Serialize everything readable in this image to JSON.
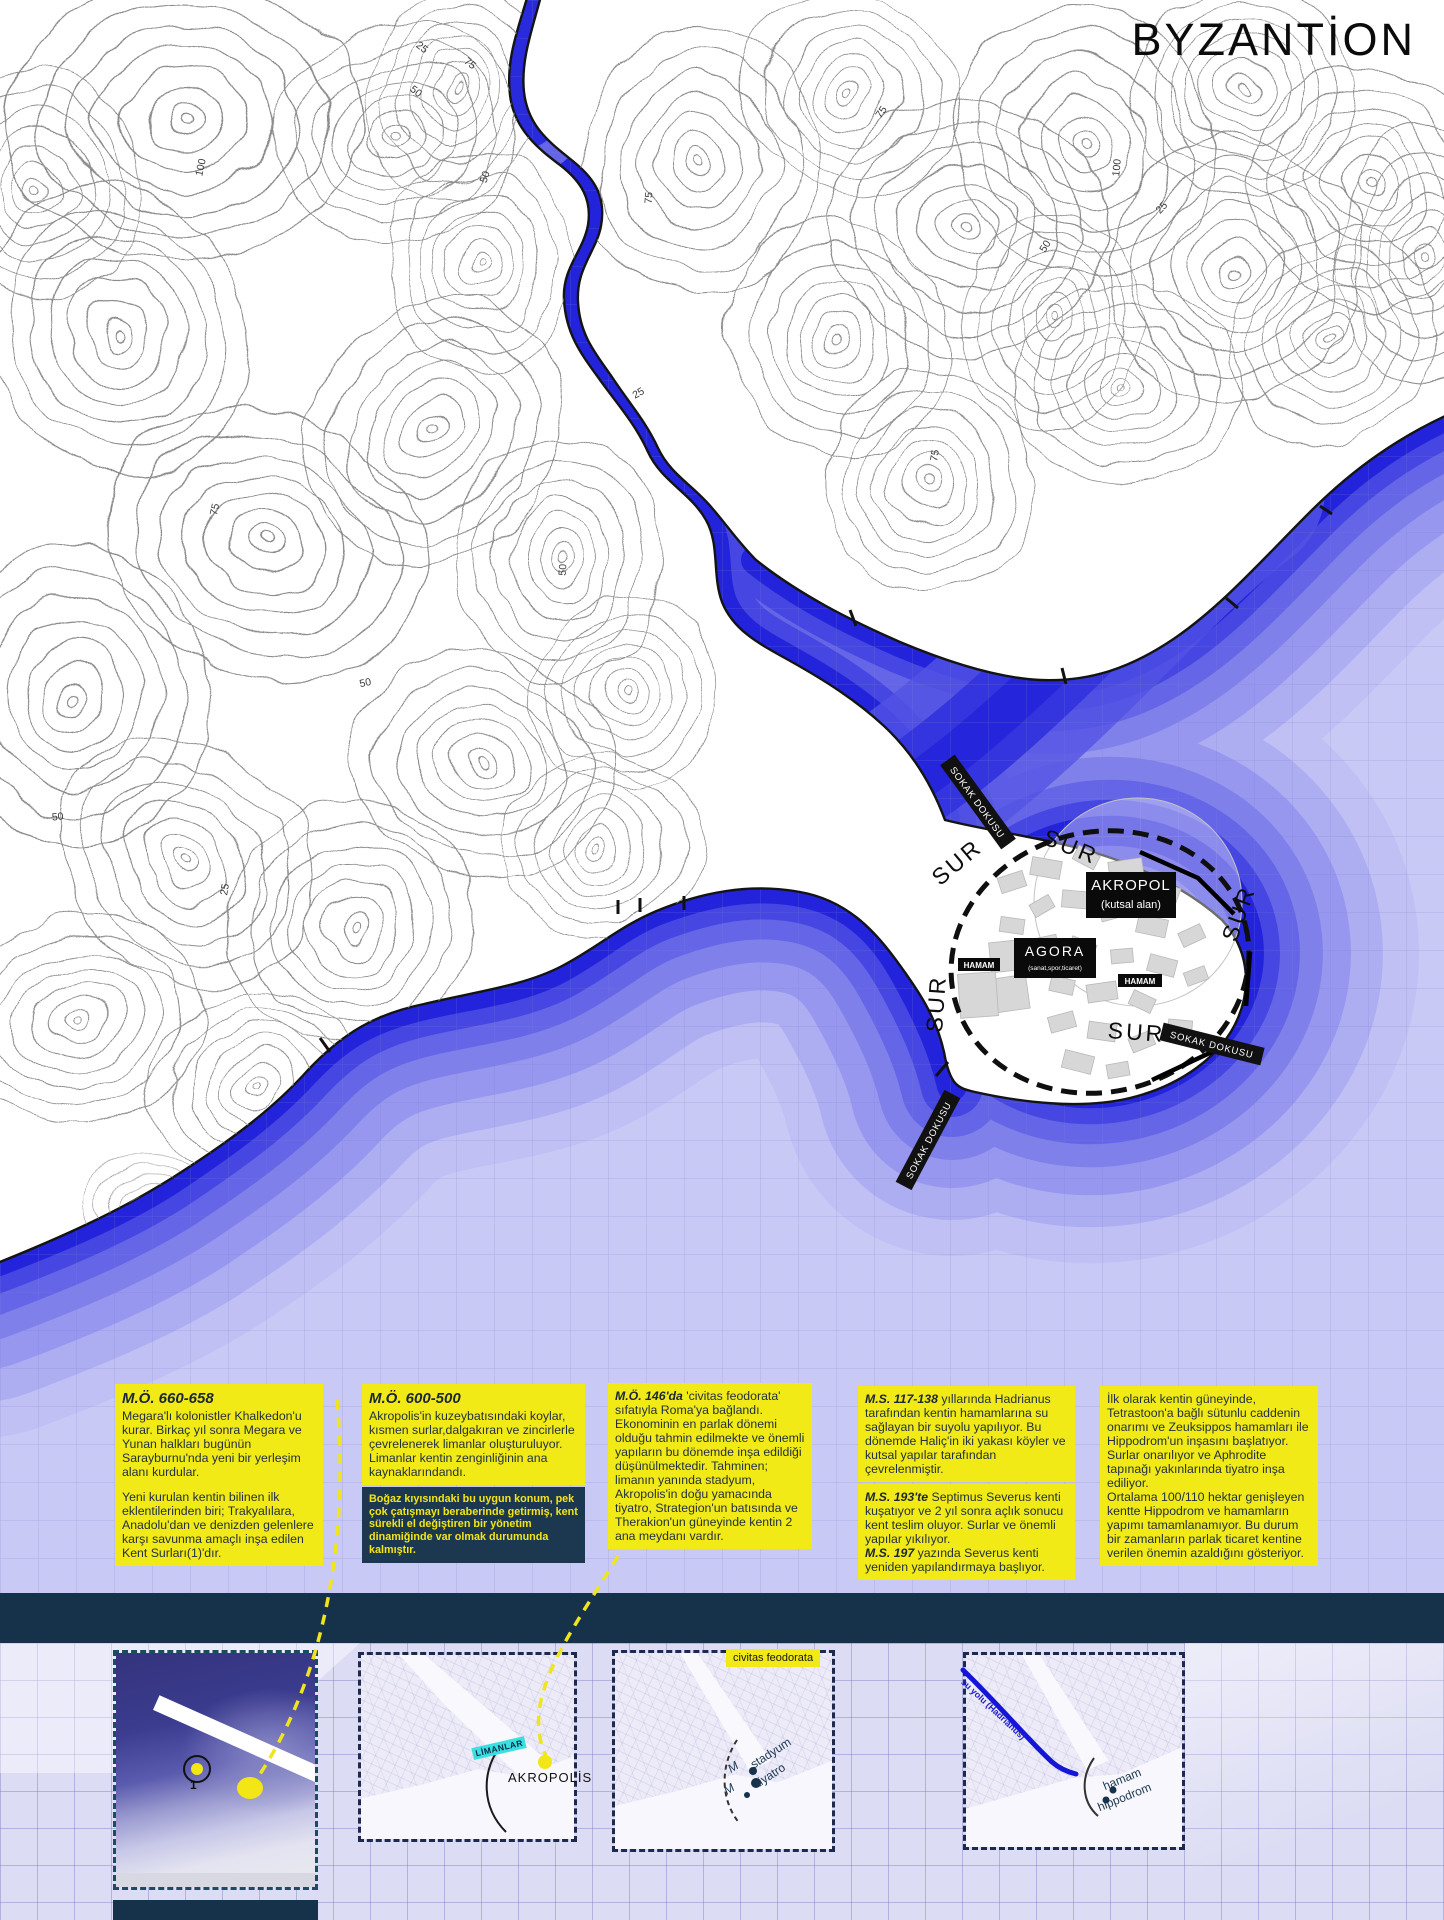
{
  "map": {
    "title": "BYZANTİON",
    "akropol": "AKROPOL",
    "akropol_sub": "(kutsal alan)",
    "agora": "AGORA",
    "agora_sub": "(sanat,spor,ticaret)",
    "hamam": "HAMAM",
    "sur": "SUR",
    "sokak_dokusu": "SOKAK DOKUSU"
  },
  "contour_labels": [
    "100",
    "25",
    "50",
    "75",
    "50",
    "75",
    "75",
    "100",
    "25",
    "75",
    "50",
    "50",
    "25",
    "50",
    "75",
    "50",
    "25"
  ],
  "timeline": [
    {
      "lead": "M.Ö. 660-658",
      "body": "Megara'lı kolonistler Khalkedon'u kurar. Birkaç yıl sonra Megara ve Yunan halkları bugünün Sarayburnu'nda yeni bir yerleşim alanı kurdular.",
      "note": "Yeni kurulan kentin bilinen ilk eklentilerinden biri; Trakyalılara, Anadolu'dan ve denizden gelenlere karşı savunma amaçlı inşa edilen Kent Surları(1)'dır."
    },
    {
      "lead": "M.Ö. 600-500",
      "body": "Akropolis'in kuzeybatısındaki koylar, kısmen surlar,dalgakıran ve zincirlerle çevrelenerek limanlar oluşturuluyor. Limanlar kentin zenginliğinin ana kaynaklarındandı.",
      "note": "Boğaz kıyısındaki bu uygun konum, pek çok çatışmayı beraberinde getirmiş, kent sürekli el değiştiren bir yönetim dinamiğinde var olmak durumunda kalmıştır."
    },
    {
      "lead": "M.Ö. 146'da",
      "body": " 'civitas feodorata' sıfatıyla Roma'ya bağlandı. Ekonominin en parlak dönemi olduğu tahmin edilmekte ve önemli yapıların bu dönemde inşa edildiği düşünülmektedir. Tahminen; limanın yanında stadyum, Akropolis'in doğu yamacında tiyatro, Strategion'un batısında ve Therakion'un güneyinde kentin 2 ana meydanı vardır."
    },
    {
      "lead": "M.S. 117-138",
      "body": " yıllarında Hadrianus tarafından kentin hamamlarına su sağlayan bir suyolu yapılıyor. Bu dönemde Haliç'in iki yakası köyler ve kutsal yapılar tarafından çevrelenmiştir.",
      "note1_lead": "M.S. 193'te",
      "note1_body": " Septimus Severus kenti kuşatıyor ve 2 yıl sonra açlık sonucu kent teslim oluyor. Surlar ve önemli yapılar yıkılıyor.",
      "note2_lead": "M.S. 197",
      "note2_body": " yazında Severus kenti yeniden yapılandırmaya başlıyor."
    },
    {
      "body": "İlk olarak kentin güneyinde, Tetrastoon'a bağlı sütunlu caddenin onarımı ve Zeuksippos hamamları ile Hippodrom'un inşasını başlatıyor. Surlar onarılıyor ve Aphrodite tapınağı yakınlarında tiyatro inşa ediliyor.",
      "body2": "Ortalama 100/110 hektar genişleyen kentte Hippodrom ve hamamların yapımı tamamlanamıyor. Bu durum bir zamanların parlak ticaret kentine verilen önemin azaldığını gösteriyor."
    }
  ],
  "thumbs": {
    "t1": {
      "marker": "1"
    },
    "t2": {
      "limanlar": "LİMANLAR",
      "akropolis": "AKROPOLİS"
    },
    "t3": {
      "tag": "civitas feodorata",
      "stadyum": "stadyum",
      "tiyatro": "tiyatro",
      "meydan": "M"
    },
    "t4": {
      "su_yolu": "su yolu (Hadrianus)",
      "hamam": "hamam",
      "hippodrom": "hippodrom"
    }
  },
  "colors": {
    "yellow": "#f2ea16",
    "deep_water": "#2323dc",
    "navy": "#16324a",
    "cyan": "#3ae0e0"
  }
}
